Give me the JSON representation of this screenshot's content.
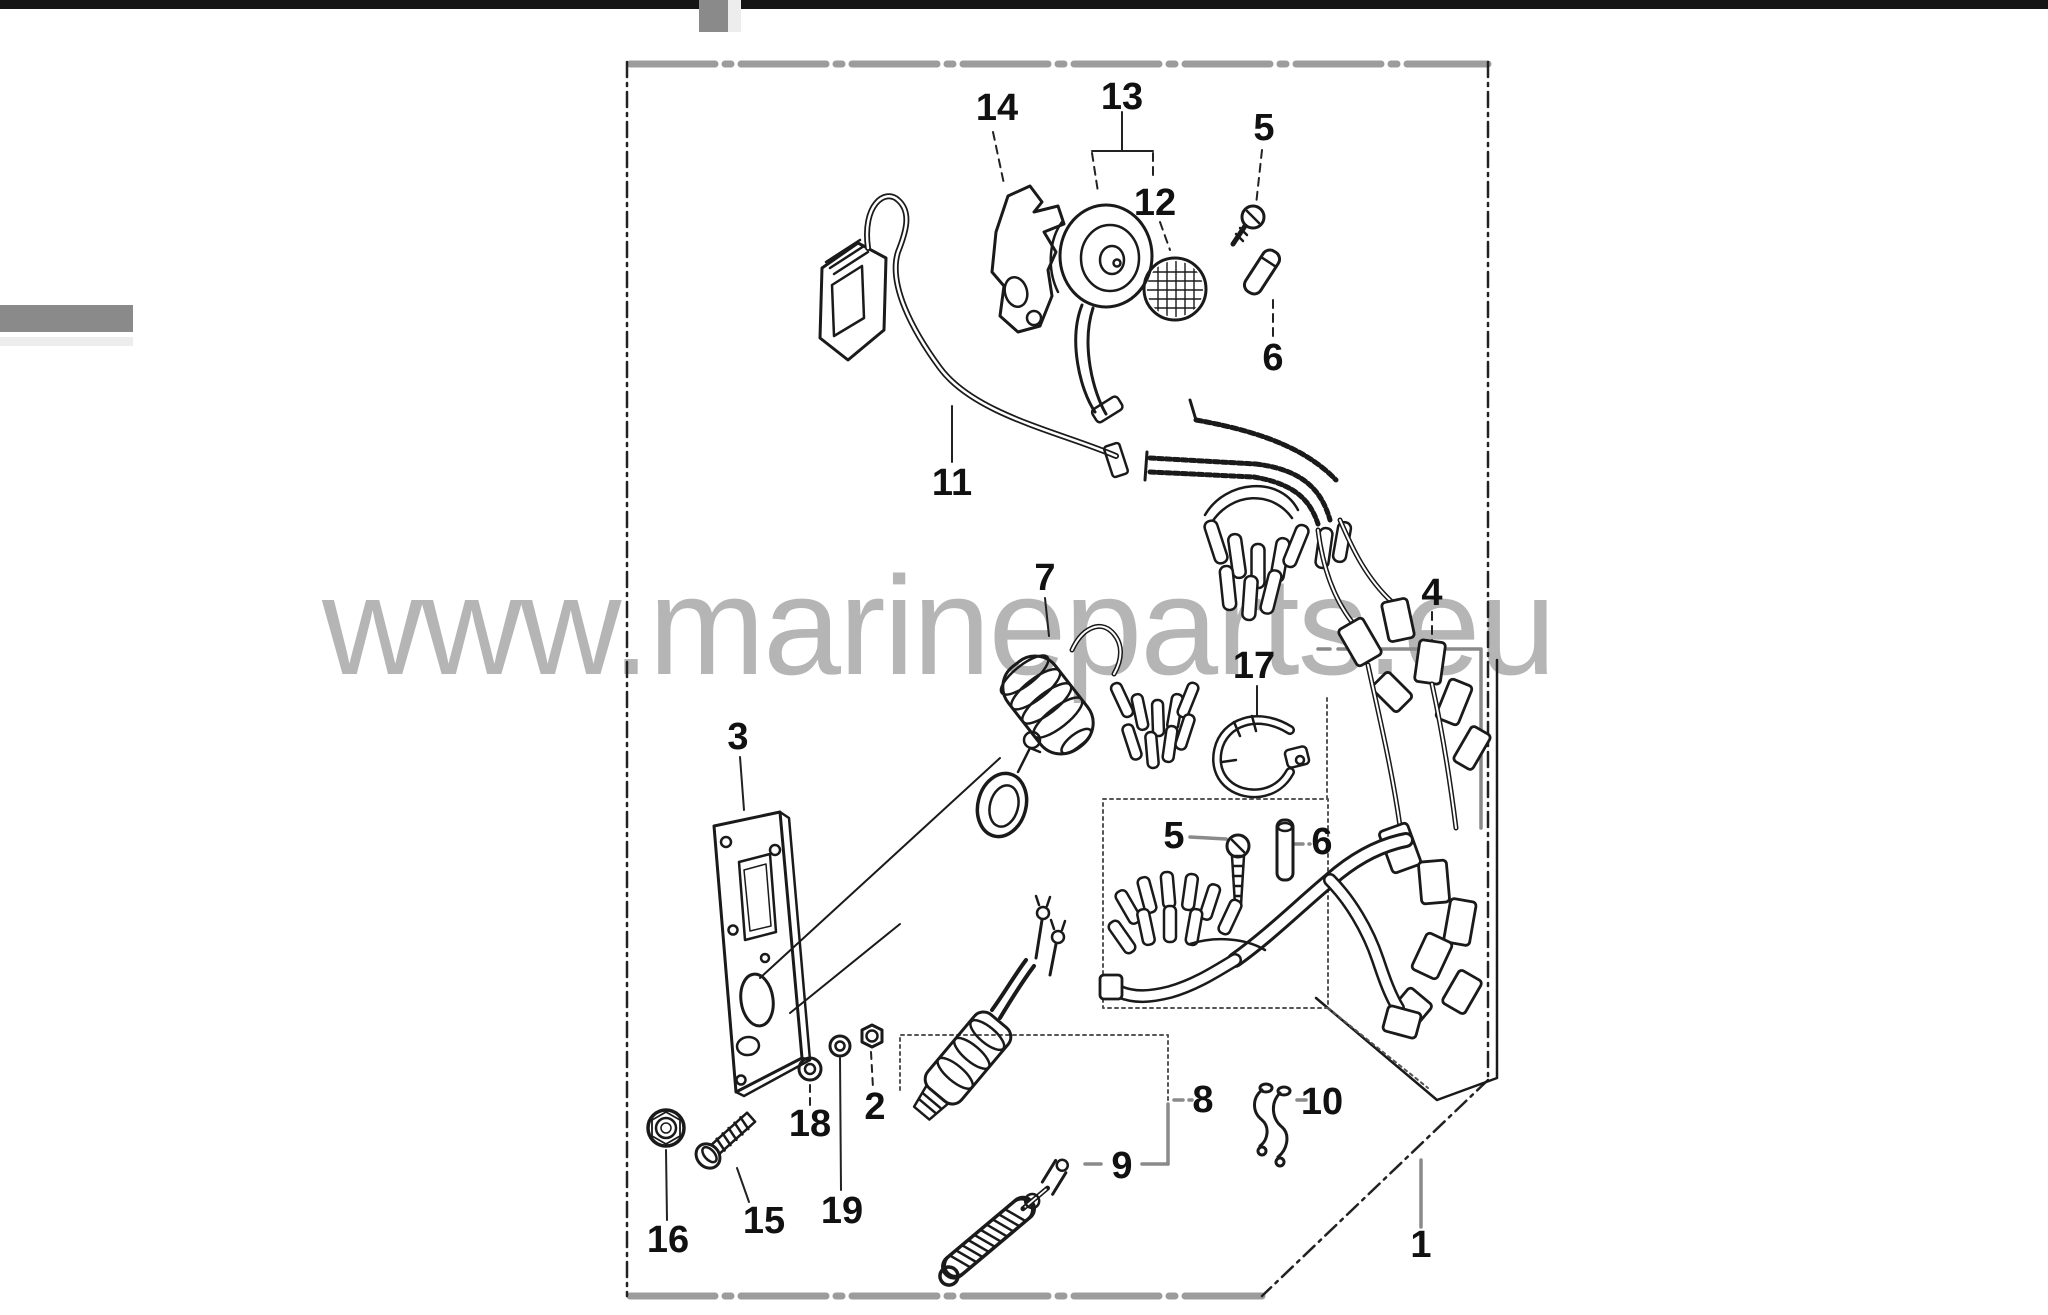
{
  "watermark": {
    "text": "www.marineparts.eu",
    "color": "#b5b5b5"
  },
  "chrome": {
    "top_bar_color": "#151515",
    "tab_color": "#8a8a8a",
    "side_marker_color": "#8a8a8a"
  },
  "diagram": {
    "line_color": "#1a1a1a",
    "leader_gray": "#8a8a8a",
    "border_gray": "#9c9c9c",
    "callouts": [
      {
        "label": "14",
        "x": 997,
        "y": 108
      },
      {
        "label": "13",
        "x": 1122,
        "y": 97
      },
      {
        "label": "12",
        "x": 1155,
        "y": 203
      },
      {
        "label": "5",
        "x": 1264,
        "y": 128
      },
      {
        "label": "6",
        "x": 1273,
        "y": 358
      },
      {
        "label": "11",
        "x": 952,
        "y": 483
      },
      {
        "label": "7",
        "x": 1045,
        "y": 578
      },
      {
        "label": "17",
        "x": 1254,
        "y": 666
      },
      {
        "label": "4",
        "x": 1432,
        "y": 593
      },
      {
        "label": "3",
        "x": 738,
        "y": 737
      },
      {
        "label": "5",
        "x": 1174,
        "y": 836
      },
      {
        "label": "6",
        "x": 1322,
        "y": 842
      },
      {
        "label": "18",
        "x": 810,
        "y": 1124
      },
      {
        "label": "2",
        "x": 875,
        "y": 1107
      },
      {
        "label": "19",
        "x": 842,
        "y": 1211
      },
      {
        "label": "15",
        "x": 764,
        "y": 1221
      },
      {
        "label": "16",
        "x": 668,
        "y": 1240
      },
      {
        "label": "8",
        "x": 1203,
        "y": 1100
      },
      {
        "label": "9",
        "x": 1122,
        "y": 1166
      },
      {
        "label": "10",
        "x": 1322,
        "y": 1102
      },
      {
        "label": "1",
        "x": 1421,
        "y": 1245
      }
    ]
  }
}
